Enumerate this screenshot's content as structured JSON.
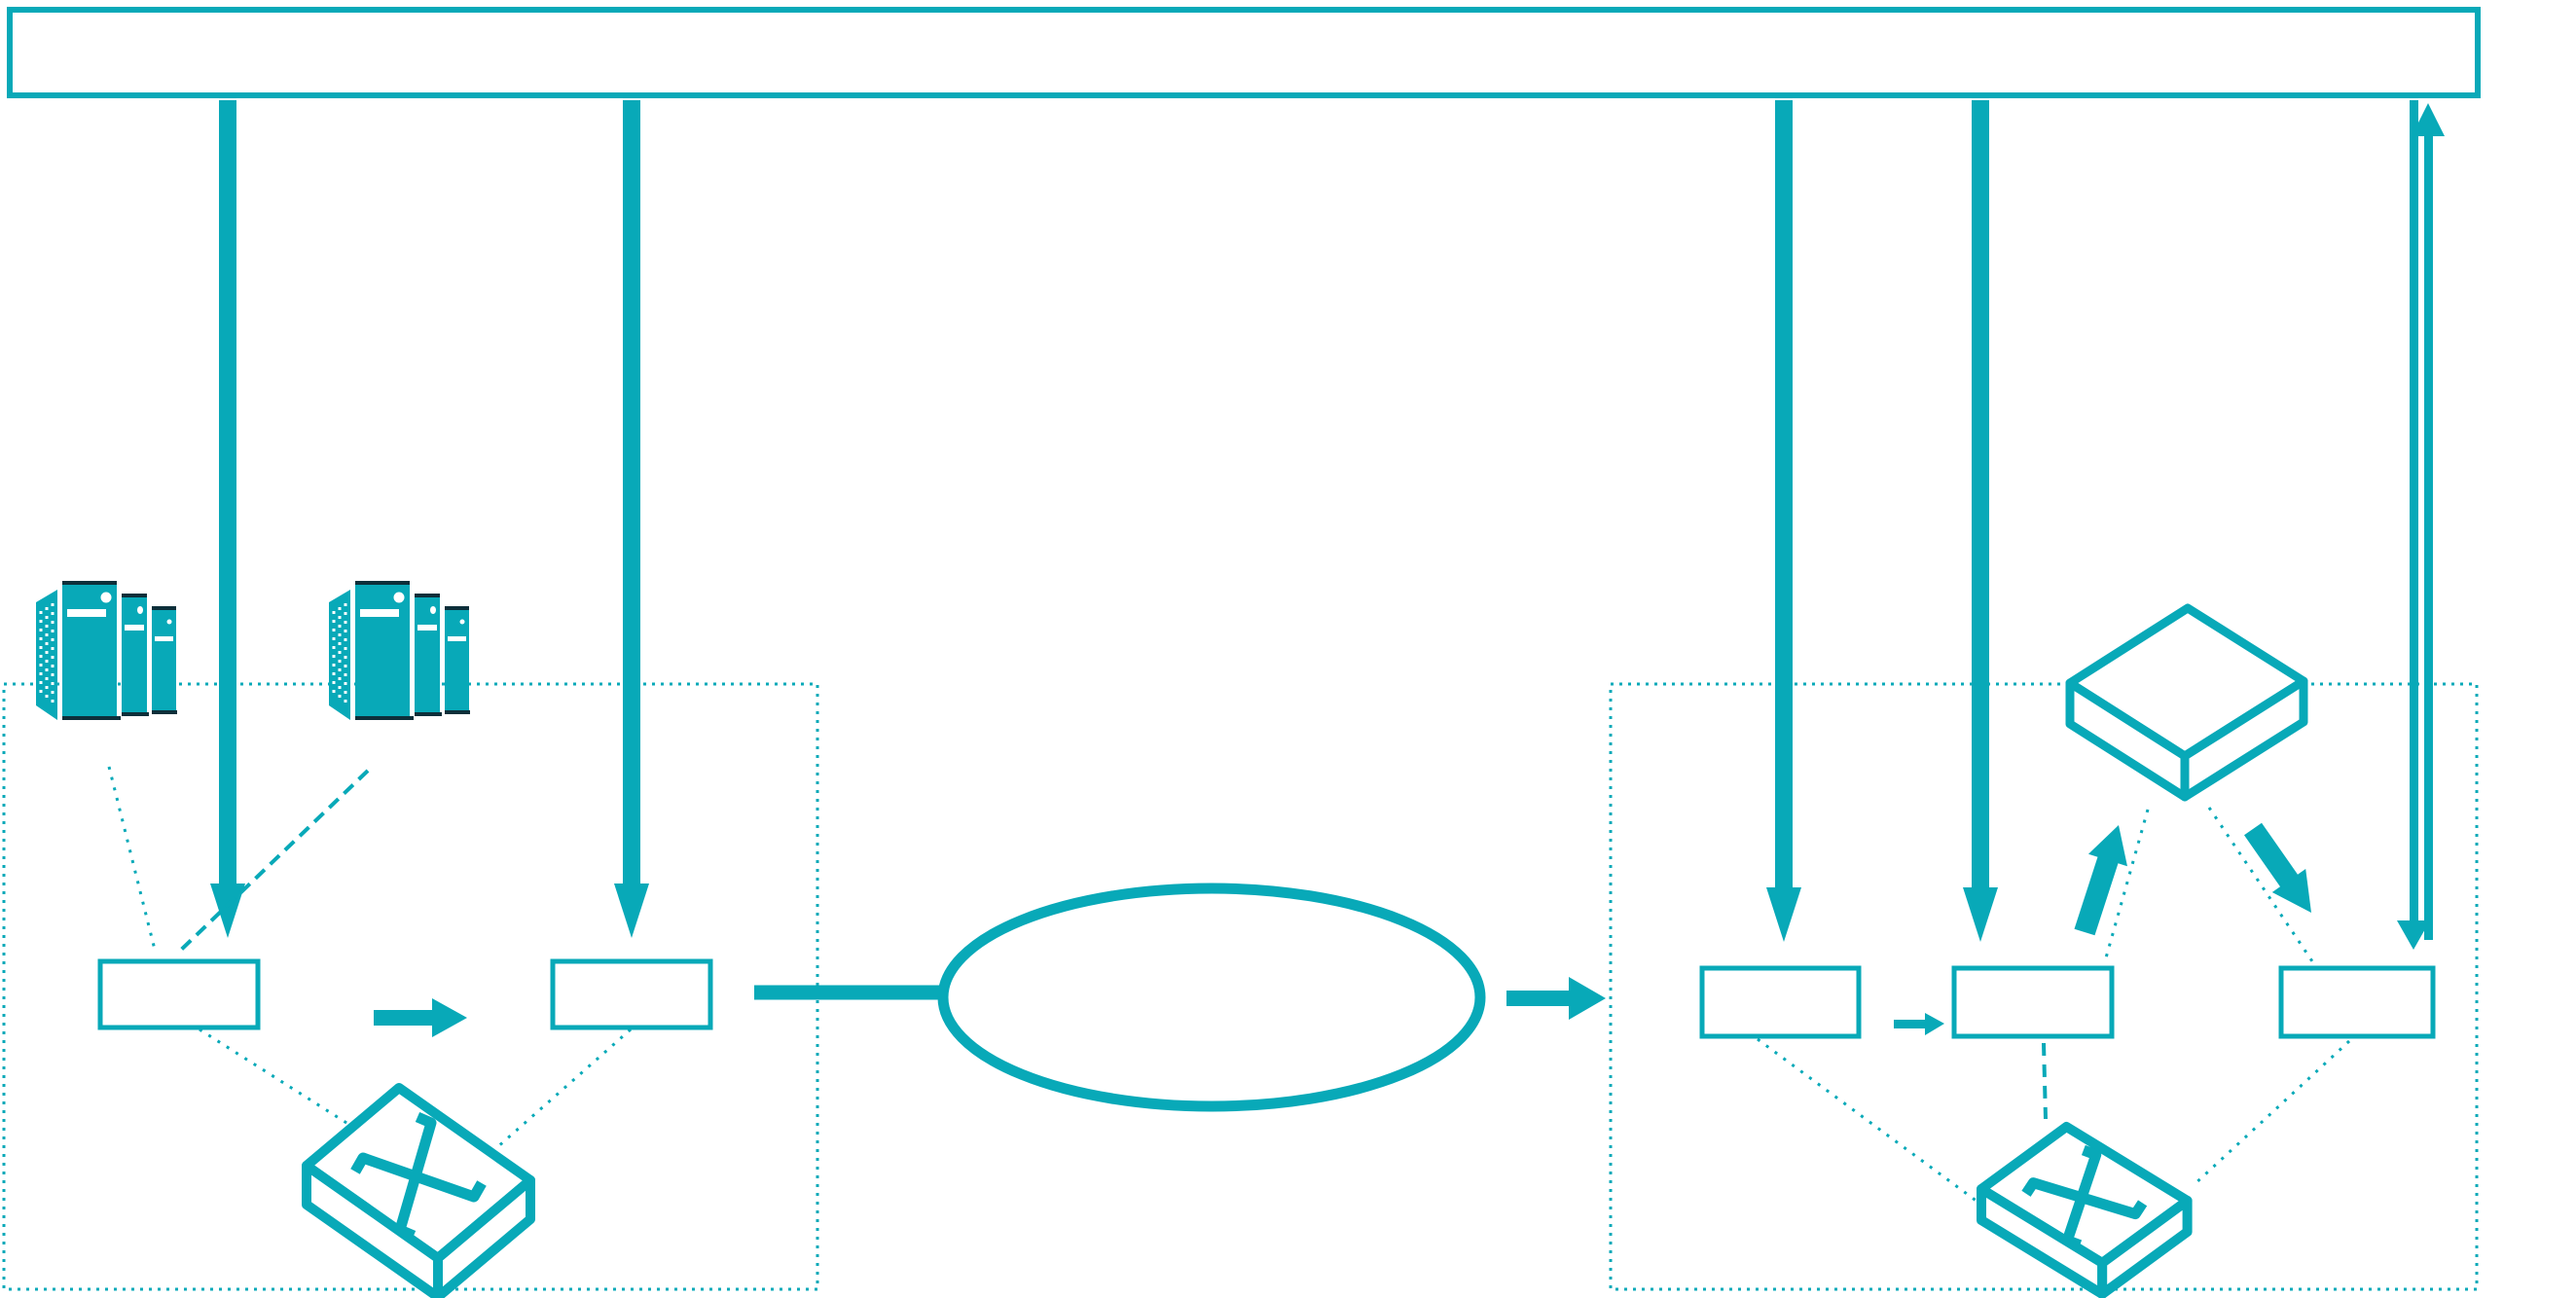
{
  "colors": {
    "accent": "#08a9b8",
    "accent_dark": "#0d2f3a",
    "background": "#ffffff",
    "shape_fill": "#ffffff"
  },
  "diagram": {
    "banner": {
      "name": "top-banner",
      "text": ""
    },
    "zones": [
      {
        "name": "left-dotted-zone"
      },
      {
        "name": "right-dotted-zone"
      }
    ],
    "icons": [
      {
        "name": "server-stack-icon",
        "instance": "left-server-group-1"
      },
      {
        "name": "server-stack-icon",
        "instance": "left-server-group-2"
      },
      {
        "name": "switch-icon",
        "instance": "left-switch"
      },
      {
        "name": "switch-icon",
        "instance": "right-switch"
      },
      {
        "name": "flat-slab-device-icon",
        "instance": "right-distributor-device"
      },
      {
        "name": "network-ellipse-icon",
        "instance": "transport-ellipse"
      }
    ],
    "boxes": [
      {
        "name": "left-box-1",
        "text": ""
      },
      {
        "name": "left-box-2",
        "text": ""
      },
      {
        "name": "right-box-1",
        "text": ""
      },
      {
        "name": "right-box-2",
        "text": ""
      },
      {
        "name": "right-box-3",
        "text": ""
      }
    ],
    "connectors": [
      {
        "name": "banner-down-arrow-1",
        "style": "thick-solid",
        "direction": "down"
      },
      {
        "name": "banner-down-arrow-2",
        "style": "thick-solid",
        "direction": "down"
      },
      {
        "name": "banner-down-arrow-3",
        "style": "thick-solid",
        "direction": "down"
      },
      {
        "name": "banner-down-arrow-4",
        "style": "thick-solid",
        "direction": "down"
      },
      {
        "name": "right-edge-down-arrow",
        "style": "thin-solid",
        "direction": "down"
      },
      {
        "name": "right-edge-up-arrow",
        "style": "thin-solid",
        "direction": "up"
      },
      {
        "name": "left-box1-to-box2-arrow",
        "style": "thick-solid",
        "direction": "right"
      },
      {
        "name": "box2-to-ellipse-line",
        "style": "thick-solid",
        "direction": "none"
      },
      {
        "name": "ellipse-to-right-zone-arrow",
        "style": "thick-solid",
        "direction": "right"
      },
      {
        "name": "rightbox1-to-rightbox2-arrow",
        "style": "thin-solid",
        "direction": "right"
      },
      {
        "name": "rightbox2-to-distributor-arrow",
        "style": "thick-solid",
        "direction": "up"
      },
      {
        "name": "distributor-to-rightbox3-arrow",
        "style": "thick-solid",
        "direction": "down"
      },
      {
        "name": "server1-to-box1-link",
        "style": "dotted",
        "direction": "none"
      },
      {
        "name": "server2-to-box1-link",
        "style": "dashed",
        "direction": "none"
      },
      {
        "name": "box1-to-switch-link",
        "style": "dotted",
        "direction": "none"
      },
      {
        "name": "box2-to-switch-link",
        "style": "dotted",
        "direction": "none"
      },
      {
        "name": "distributor-to-rightbox2-link",
        "style": "dotted",
        "direction": "none"
      },
      {
        "name": "distributor-to-rightbox3-link",
        "style": "dotted",
        "direction": "none"
      },
      {
        "name": "rightbox1-to-switch-link",
        "style": "dotted",
        "direction": "none"
      },
      {
        "name": "rightbox2-to-switch-link",
        "style": "dashed",
        "direction": "none"
      },
      {
        "name": "rightbox3-to-switch-link",
        "style": "dotted",
        "direction": "none"
      }
    ]
  }
}
